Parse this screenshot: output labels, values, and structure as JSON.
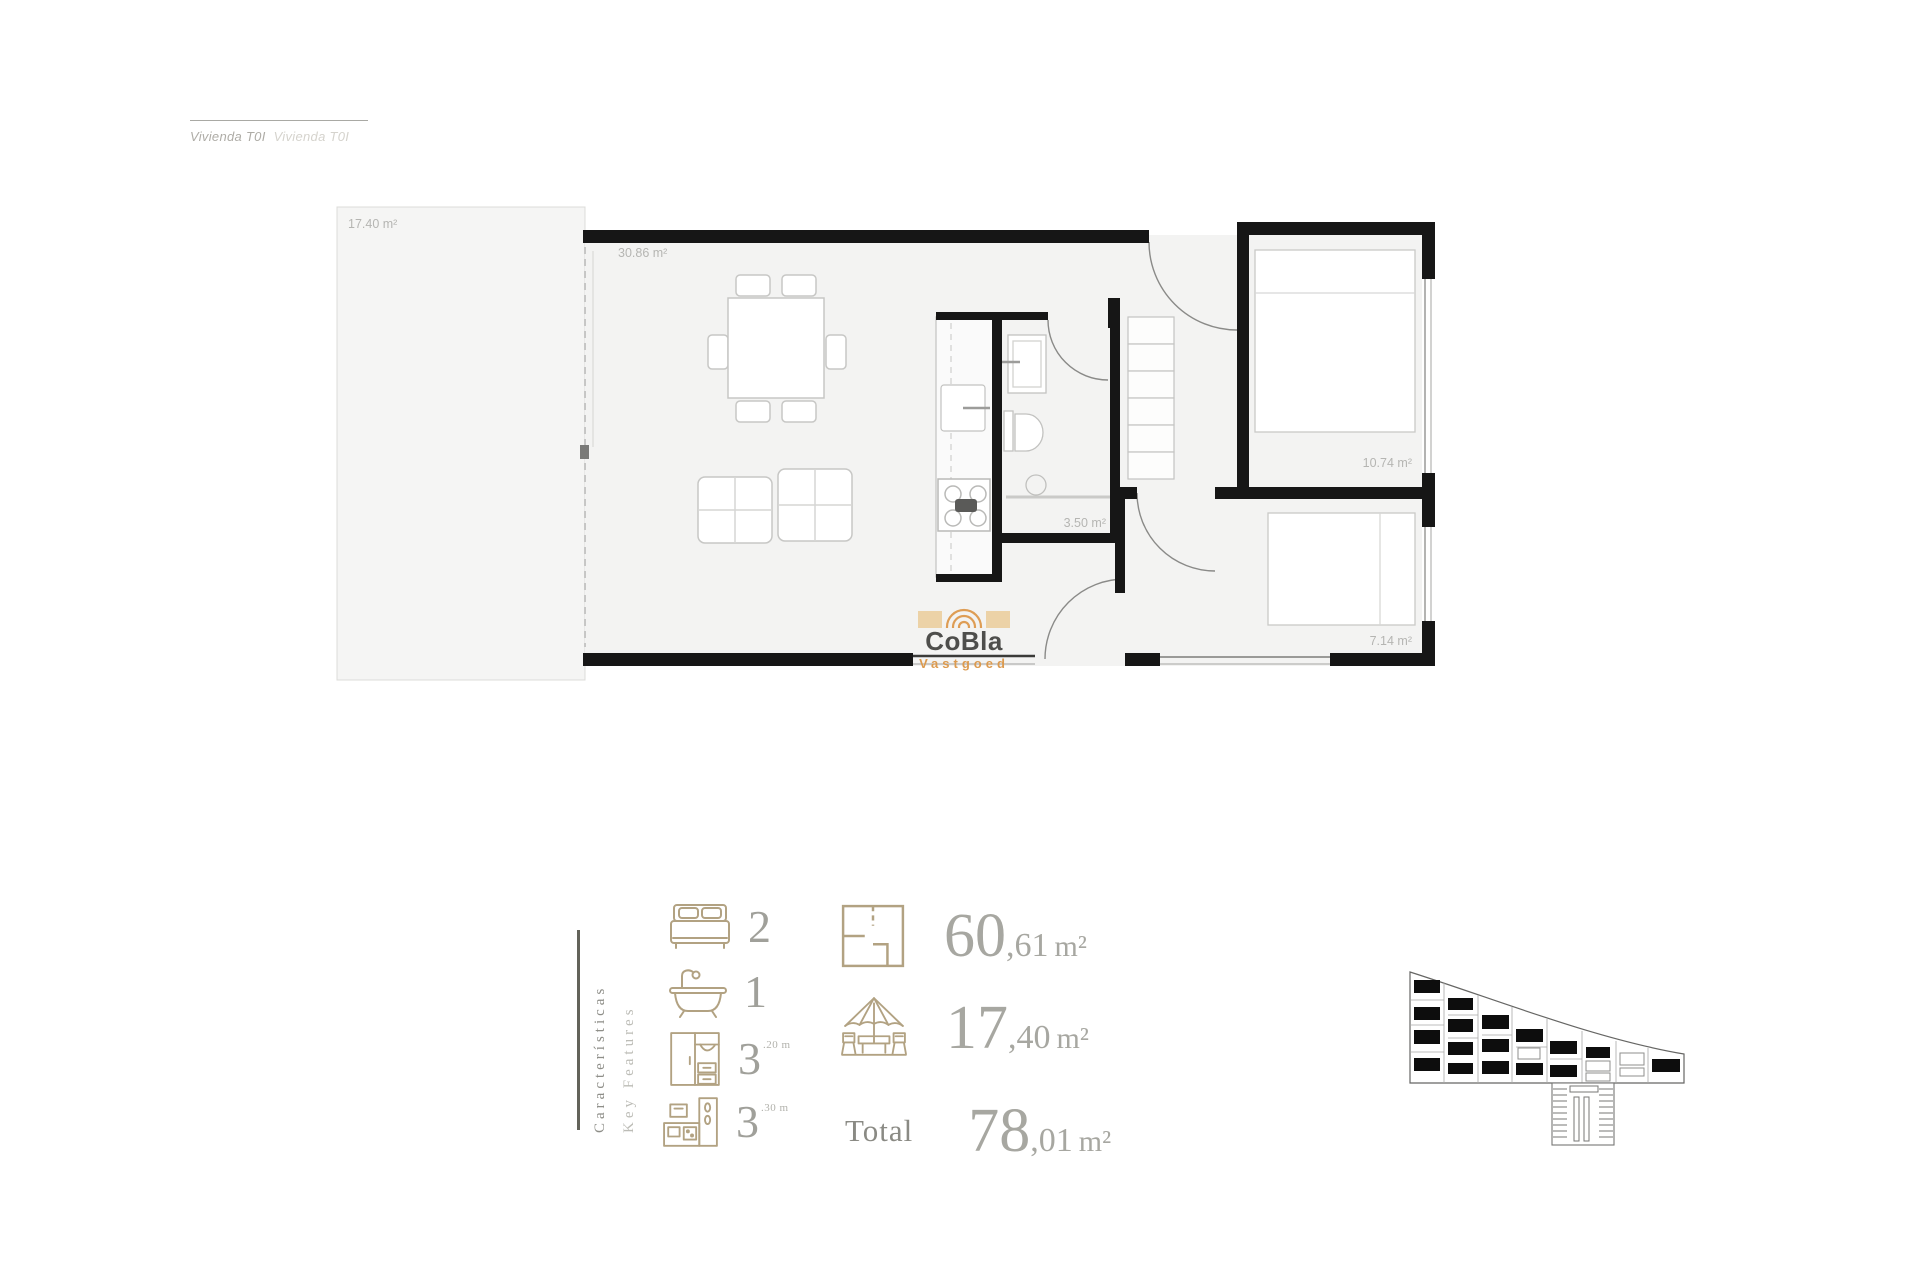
{
  "header": {
    "title_es": "Vivienda T0I",
    "title_en": "Vivienda T0I"
  },
  "plan": {
    "terrace_area": "17.40 m²",
    "living_area": "30.86 m²",
    "bathroom_area": "3.50 m²",
    "bedroom1_area": "10.74 m²",
    "bedroom2_area": "7.14 m²"
  },
  "logo": {
    "brand": "CoBla",
    "tagline": "Vastgoed"
  },
  "features": {
    "heading_es": "Características",
    "heading_en": "Key Features",
    "bedrooms": {
      "value": "2"
    },
    "bathrooms": {
      "value": "1"
    },
    "wardrobe": {
      "value": "3",
      "sup": ".20 m"
    },
    "kitchen": {
      "value": "3",
      "sup": ".30 m"
    },
    "built_area": {
      "int": "60",
      "frac": ",61",
      "unit": "m²"
    },
    "terrace_area": {
      "int": "17",
      "frac": ",40",
      "unit": "m²"
    },
    "total": {
      "label": "Total",
      "int": "78",
      "frac": ",01",
      "unit": "m²"
    }
  }
}
